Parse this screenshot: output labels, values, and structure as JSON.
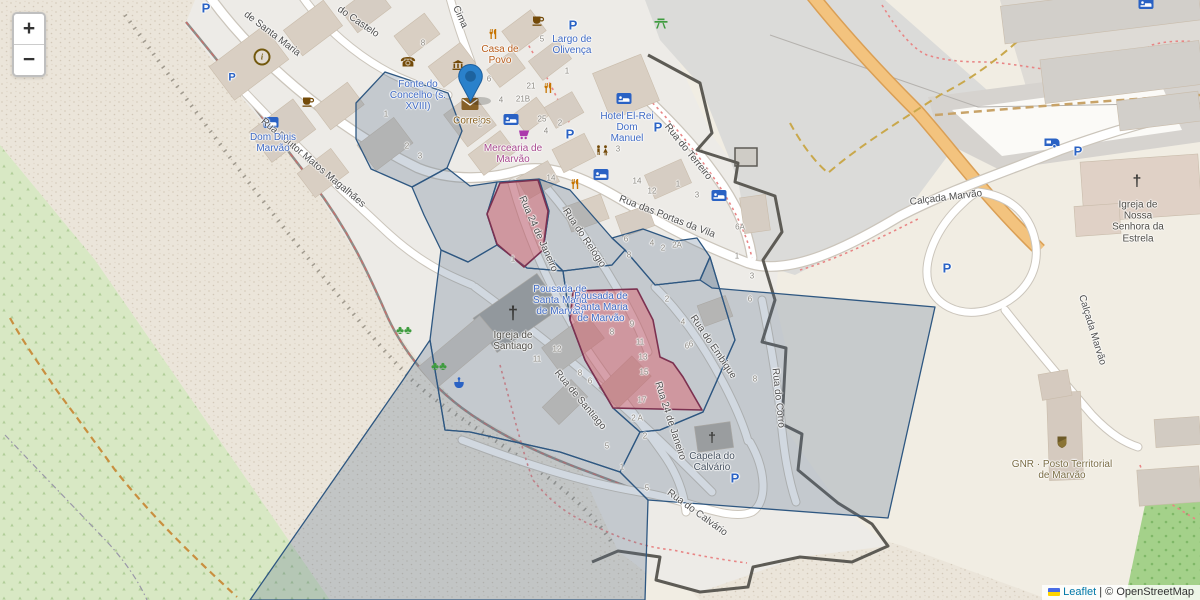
{
  "controls": {
    "zoom_in": "+",
    "zoom_out": "−"
  },
  "attribution": {
    "leaflet": "Leaflet",
    "separator": "|",
    "copyright": "© OpenStreetMap"
  },
  "colors": {
    "marker_blue": "#2A81CB",
    "overlay_blue_stroke": "#2e5781",
    "overlay_blue_fill": "rgba(90,115,145,0.28)",
    "overlay_red_stroke": "#7c3150",
    "overlay_red_fill": "rgba(222,84,95,0.42)",
    "link_blue": "#0078A8",
    "road_orange": "#f3c37e"
  },
  "streets": [
    {
      "name": "do Castelo"
    },
    {
      "name": "Cima"
    },
    {
      "name": "de Santa Maria"
    },
    {
      "name": "Rua Doutor Matos Magalhães"
    },
    {
      "name": "Rua do Terreiro"
    },
    {
      "name": "Rua das Portas da Vila"
    },
    {
      "name": "Rua do Relógio"
    },
    {
      "name": "Rua 24 de Janeiro"
    },
    {
      "name": "Rua de Santiago"
    },
    {
      "name": "Rua do Embique"
    },
    {
      "name": "Rua do Corro"
    },
    {
      "name": "Rua 24 de Janeiro"
    },
    {
      "name": "Rua do Calvário"
    },
    {
      "name": "Calçada Marvão"
    },
    {
      "name": "Calçada Marvão"
    }
  ],
  "pois": [
    {
      "name": "Largo de Olivença"
    },
    {
      "name": "Casa de Povo"
    },
    {
      "name": "Fonte do Concelho (s. XVIII)"
    },
    {
      "name": "Correios"
    },
    {
      "name": "Mercearia de Marvão"
    },
    {
      "name": "Dom Dinis Marvão"
    },
    {
      "name": "Hotel El-Rei Dom Manuel"
    },
    {
      "name": "Pousada de Santa Maria de Marvão"
    },
    {
      "name": "Pousada de Santa Maria de Marvão"
    },
    {
      "name": "Igreja de Santiago"
    },
    {
      "name": "Capela do Calvário"
    },
    {
      "name": "Igreja de Nossa Senhora da Estrela"
    },
    {
      "name": "GNR · Posto Territorial de Marvão"
    }
  ],
  "house_numbers": [
    "8",
    "6",
    "4",
    "21",
    "21B",
    "2",
    "25",
    "4",
    "5",
    "1",
    "14",
    "12",
    "1",
    "3",
    "6A",
    "1",
    "3",
    "6",
    "6",
    "4",
    "2",
    "2A",
    "8",
    "1",
    "2",
    "4",
    "6",
    "9",
    "8",
    "11",
    "13",
    "15",
    "17",
    "2 A",
    "2",
    "5",
    "1",
    "5",
    "12",
    "11",
    "8",
    "6",
    "8",
    "6",
    "14",
    "3",
    "2",
    "3",
    "2",
    "1"
  ]
}
